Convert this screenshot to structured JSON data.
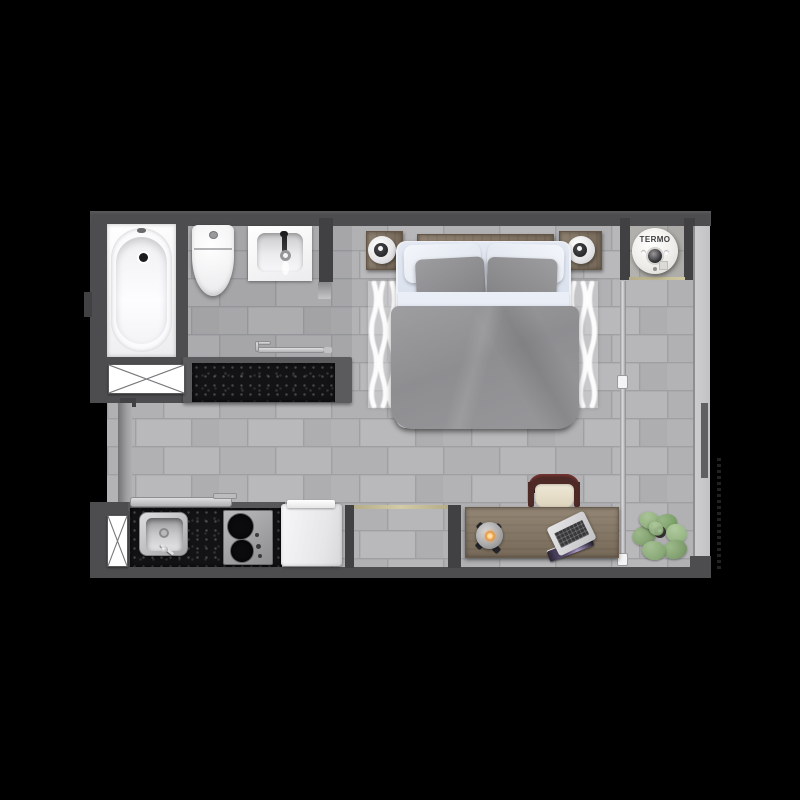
{
  "title": "Studio apartment floor plan (top-down render)",
  "labels": {
    "water_heater": "TERMO"
  },
  "palette": {
    "background": "#000000",
    "wall": "#4d4d4f",
    "floor_tile": "#b4b4b6",
    "grout": "#9fa0a2",
    "granite_counter": "#131315",
    "wood": "#857664",
    "glass_wall": "#cdcdcf",
    "door_track_tan": "#c9c0a0",
    "bedding_white": "#e2e7f1",
    "bedding_gray": "#97979a",
    "lamp_glow": "#e8973f",
    "plant_green": "#88a876",
    "chair_maroon": "#4e2a27"
  },
  "rooms": [
    "bathroom",
    "kitchen",
    "living-bedroom",
    "hallway",
    "water-heater-niche",
    "entry"
  ],
  "furniture": [
    "bathtub",
    "toilet",
    "washbasin",
    "bathroom-storage-box",
    "vanity-counter",
    "towel-rail",
    "double-bed",
    "headboard",
    "nightstand-left",
    "nightstand-right",
    "table-lamp-left",
    "table-lamp-right",
    "area-rug",
    "water-heater",
    "sliding-door",
    "kitchen-shelf",
    "kitchen-sink",
    "cooktop",
    "refrigerator",
    "kitchen-storage-box",
    "entry-doorway",
    "desk",
    "desk-chair",
    "desk-lamp",
    "laptop",
    "potted-plant"
  ]
}
